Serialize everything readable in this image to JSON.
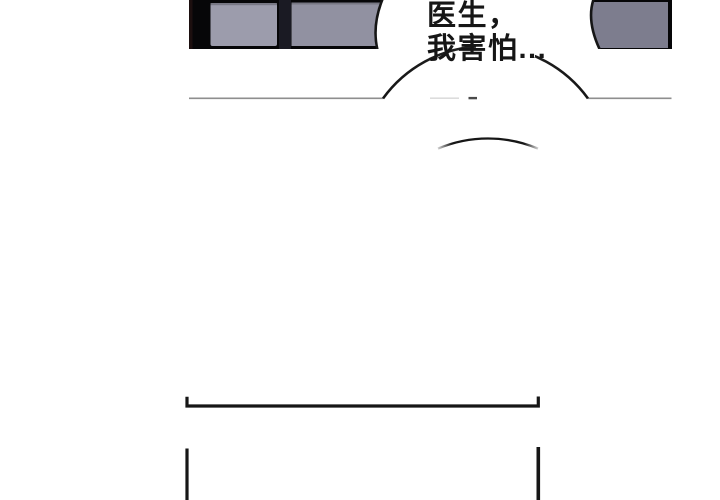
{
  "comic_page": {
    "speech_bubble": {
      "line1": "医生，",
      "line2": "我害怕..."
    },
    "colors": {
      "page_bg": "#ffffff",
      "panel_bg": "#060608",
      "panel_left_tint": "#1c0f0f",
      "panel_gap_band": "#1a1a23",
      "gray_block_left": "#9c9cac",
      "gray_block_mid": "#9191a1",
      "gray_block_right": "#7d7d8e",
      "block_top_shade": "#72727e",
      "bubble_fill": "#ffffff",
      "ink": "#161616",
      "divider_line": "#8e8e8e",
      "faint_dash_light": "#dcdcdc",
      "faint_dash_dark": "#4a4a4a"
    }
  }
}
